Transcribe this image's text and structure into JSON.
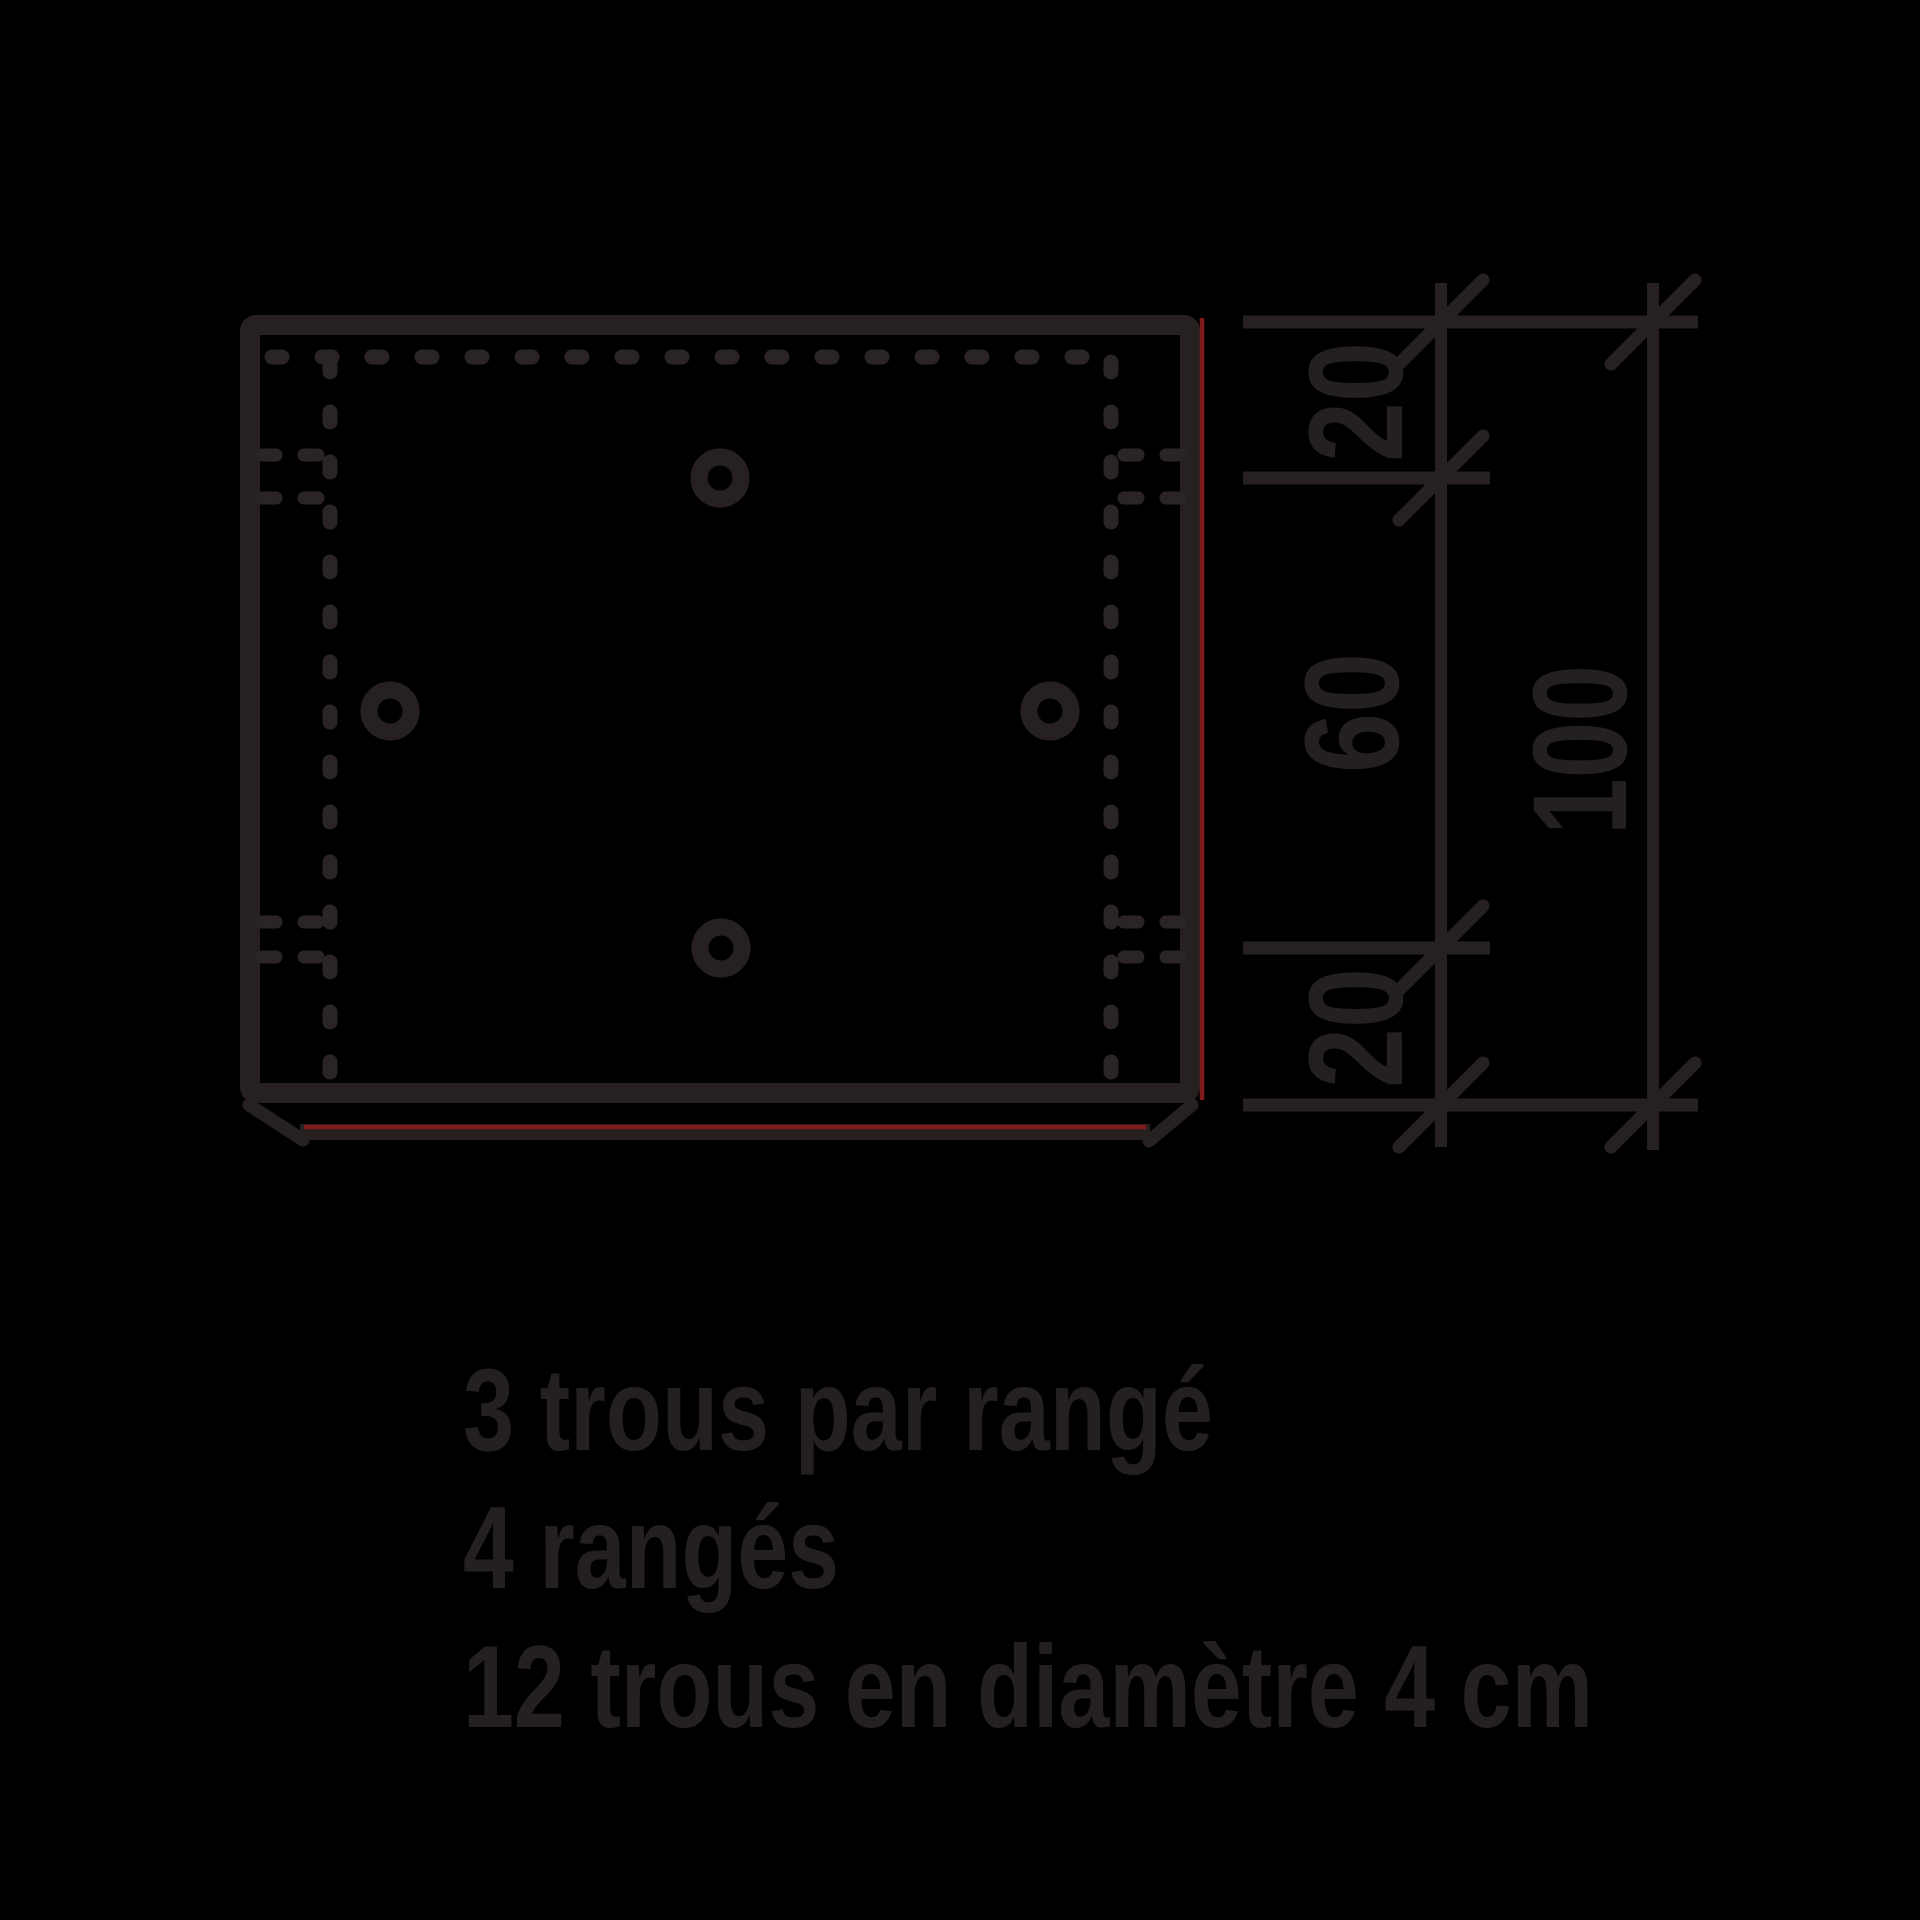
{
  "colors": {
    "background": "#000000",
    "ink": "#262020",
    "ink-soft": "#2b2424",
    "ink-text": "#242020",
    "red-accent": "#7f1b1b"
  },
  "drawing": {
    "dim_labels": {
      "top_offset": "20",
      "middle_span": "60",
      "bottom_offset": "20",
      "overall_height": "100"
    },
    "notes": {
      "line1": "3 trous par rangé",
      "line2": "4 rangés",
      "line3": "12 trous en diamètre 4 cm"
    },
    "holes": {
      "per_row": "3",
      "rows": "4",
      "total": "12",
      "diameter_cm": "4"
    }
  }
}
